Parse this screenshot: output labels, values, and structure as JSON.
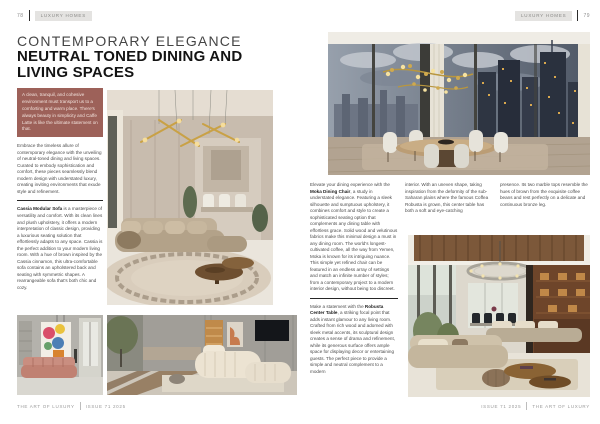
{
  "header_left": {
    "page_number": "78",
    "badge": "LUXURY HOMES"
  },
  "header_right": {
    "badge": "LUXURY HOMES",
    "page_number": "79"
  },
  "title": {
    "kicker": "CONTEMPORARY ELEGANCE",
    "headline": "NEUTRAL TONED DINING AND LIVING SPACES"
  },
  "quote": {
    "text": "A clean, tranquil, and cohesive environment must transport us to a comforting and warm place. There's always beauty in simplicity and Caffe Latte is like the ultimate statement on that."
  },
  "left_column": {
    "para1": "Embrace the timeless allure of contemporary elegance with the unveiling of neutral-toned dining and living spaces. Curated to embody sophistication and comfort, these pieces seamlessly blend modern design with understated luxury, creating inviting environments that exude style and refinement.",
    "cassia_bold": "Cassia Modular Sofa",
    "cassia_rest": " is a masterpiece of versatility and comfort. With its clean lines and plush upholstery, it offers a modern interpretation of classic design, providing a luxurious seating solution that effortlessly adapts to any space. Cassia is the perfect addition to your modern living room. With a hue of brown inspired by the Cassia cinnamon, this ultra-comfortable sofa contains an upholstered back and seating with symmetric shapes. A rearrangeable sofa that's both chic and cozy."
  },
  "right_page": {
    "col1": {
      "p1_before": "Elevate your dining experience with the ",
      "p1_bold": "Moka Dining Chair",
      "p1_after": ", a study in understated elegance. Featuring a sleek silhouette and sumptuous upholstery, it combines comfort and style to create a sophisticated seating option that complements any dining table with effortless grace. Solid wood and velutinous fabrics make this minimal design a must in any dining room. The world's longest-cultivated coffee, all the way from Yemen, Moka is known for its intriguing nuance. This simple yet refined chair can be featured in an endless array of settings and match an infinite number of styles; from a contemporary project to a modern interior design, without being too discreet.",
      "p2_before": "Make a statement with the ",
      "p2_bold": "Robusta Center Table",
      "p2_after": ", a striking focal point that adds instant glamour to any living room. Crafted from rich wood and adorned with sleek metal accents, its sculptural design creates a sense of drama and refinement, while its generous surface offers ample space for displaying decor or entertaining guests. The perfect piece to provide a simple and neutral complement to a modern"
    },
    "col2_text": "interior. With an uneven shape, taking inspiration from the deformity of the sub-Saharan plains where the famous Coffea Robusta is grown, this center table has both a soft and eye-catching",
    "col3_text": "presence. Its two marble tops resemble the hues of brown from the exquisite coffee beans and rest perfectly on a delicate and continuous bronze leg."
  },
  "footer_left": {
    "magazine": "THE ART OF LUXURY",
    "issue": "ISSUE 71 2025"
  },
  "footer_right": {
    "issue": "ISSUE 71 2025",
    "magazine": "THE ART OF LUXURY"
  },
  "colors": {
    "quote_box_bg": "#9d6159",
    "headline_text": "#131313",
    "badge_bg": "#e4e3e1",
    "gold_accent": "#c9a145"
  }
}
